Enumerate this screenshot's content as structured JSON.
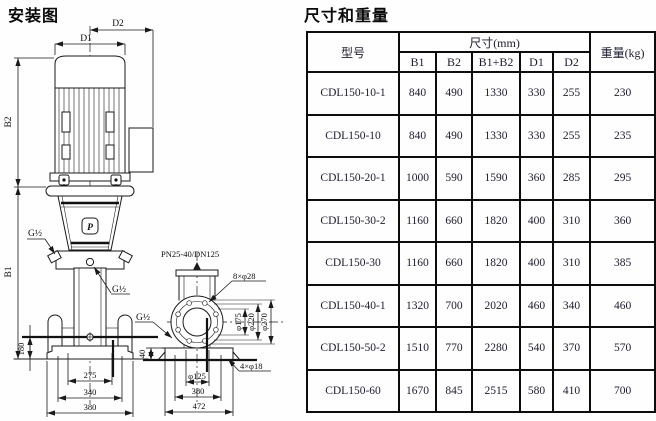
{
  "page": {
    "left_title": "安装图",
    "right_title": "尺寸和重量"
  },
  "diagram": {
    "labels": {
      "d2": "D2",
      "d1": "D1",
      "b2": "B2",
      "b1": "B1",
      "g_half_left": "G½",
      "g_half_right": "G½",
      "g_half_side": "G½",
      "pn_flange": "PN25-40/DN125",
      "holes8": "8×φ28",
      "holes4": "4×φ18",
      "phi175": "φ175",
      "phi220": "φ220",
      "phi270": "φ270",
      "phi125": "φ125",
      "dim180": "180",
      "dim275": "275",
      "dim340": "340",
      "dim380_front": "380",
      "dim40": "40",
      "dim380_side": "380",
      "dim472": "472",
      "logo_glyph": "P"
    }
  },
  "table": {
    "col_model": "型号",
    "col_dims_group": "尺寸(mm)",
    "col_weight": "重量(kg)",
    "dim_cols": [
      "B1",
      "B2",
      "B1+B2",
      "D1",
      "D2"
    ],
    "rows": [
      {
        "model": "CDL150-10-1",
        "b1": "840",
        "b2": "490",
        "b1b2": "1330",
        "d1": "330",
        "d2": "255",
        "weight": "230"
      },
      {
        "model": "CDL150-10",
        "b1": "840",
        "b2": "490",
        "b1b2": "1330",
        "d1": "330",
        "d2": "255",
        "weight": "235"
      },
      {
        "model": "CDL150-20-1",
        "b1": "1000",
        "b2": "590",
        "b1b2": "1590",
        "d1": "360",
        "d2": "285",
        "weight": "295"
      },
      {
        "model": "CDL150-30-2",
        "b1": "1160",
        "b2": "660",
        "b1b2": "1820",
        "d1": "400",
        "d2": "310",
        "weight": "360"
      },
      {
        "model": "CDL150-30",
        "b1": "1160",
        "b2": "660",
        "b1b2": "1820",
        "d1": "400",
        "d2": "310",
        "weight": "385"
      },
      {
        "model": "CDL150-40-1",
        "b1": "1320",
        "b2": "700",
        "b1b2": "2020",
        "d1": "460",
        "d2": "340",
        "weight": "460"
      },
      {
        "model": "CDL150-50-2",
        "b1": "1510",
        "b2": "770",
        "b1b2": "2280",
        "d1": "540",
        "d2": "370",
        "weight": "570"
      },
      {
        "model": "CDL150-60",
        "b1": "1670",
        "b2": "845",
        "b1b2": "2515",
        "d1": "580",
        "d2": "410",
        "weight": "700"
      }
    ]
  }
}
